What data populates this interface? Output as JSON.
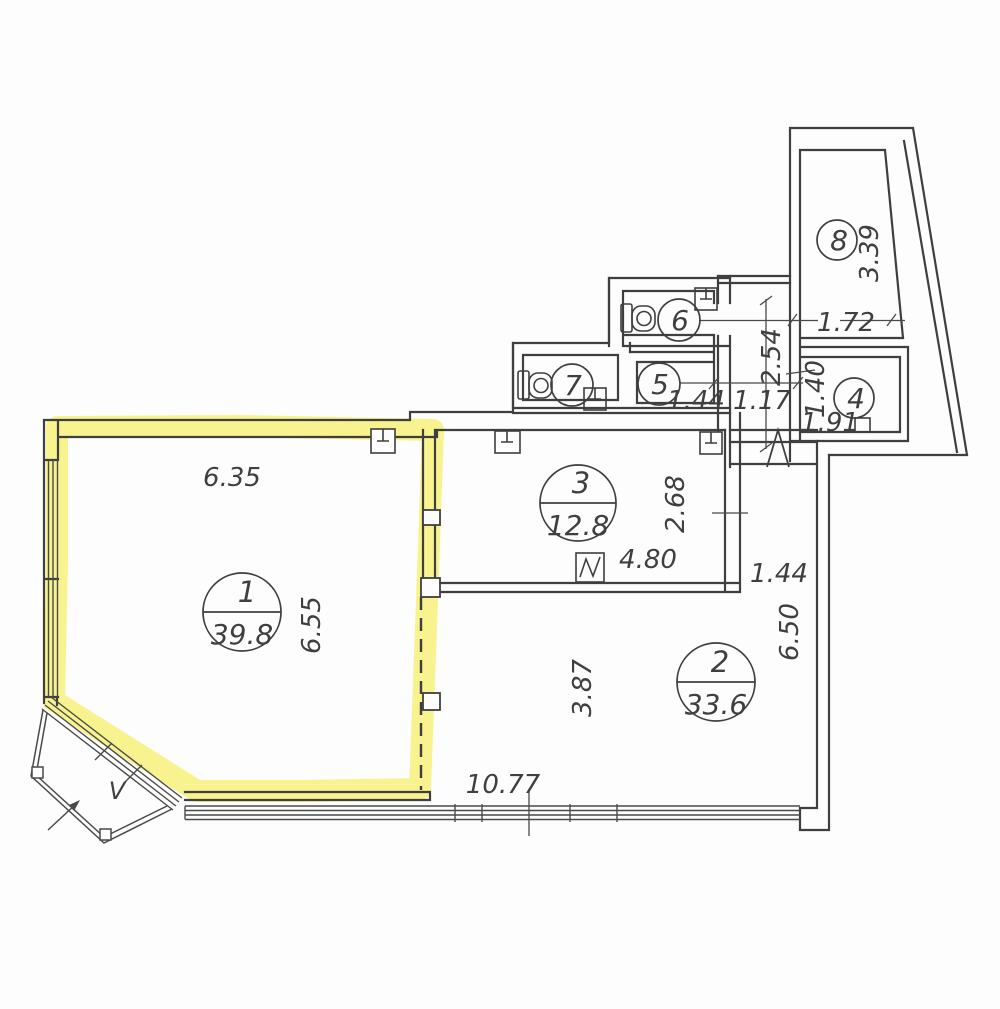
{
  "plan": {
    "rooms": [
      {
        "number": "1",
        "area": "39.8",
        "highlighted": true,
        "width_m": "6.35",
        "height_m": "6.55"
      },
      {
        "number": "2",
        "area": "33.6",
        "width_m": "10.77",
        "depth_mid_m": "3.87",
        "depth_right_m": "6.50",
        "nook_width_m": "1.44"
      },
      {
        "number": "3",
        "area": "12.8",
        "width_m": "4.80",
        "depth_m": "2.68"
      },
      {
        "number": "4",
        "height_m": "1.40",
        "width_m": "1.91"
      },
      {
        "number": "5",
        "width_m": "1.44"
      },
      {
        "number": "6"
      },
      {
        "number": "7"
      },
      {
        "number": "8",
        "width_m": "1.72",
        "height_m": "3.39"
      }
    ],
    "corridor": {
      "width_m": "1.17",
      "length_m": "2.54"
    },
    "balcony": {
      "label": "V"
    },
    "colors": {
      "highlight": "#f6ed4a",
      "line": "#3f3f3f",
      "thin_line": "#4a4a4a",
      "background": "#fdfdfd"
    },
    "icons": [
      "toilet-icon",
      "sink-icon",
      "electrical-panel-icon",
      "vent-box-icon",
      "riser-icon",
      "entrance-arrow-icon",
      "balcony-arrow-icon",
      "window-band"
    ]
  }
}
